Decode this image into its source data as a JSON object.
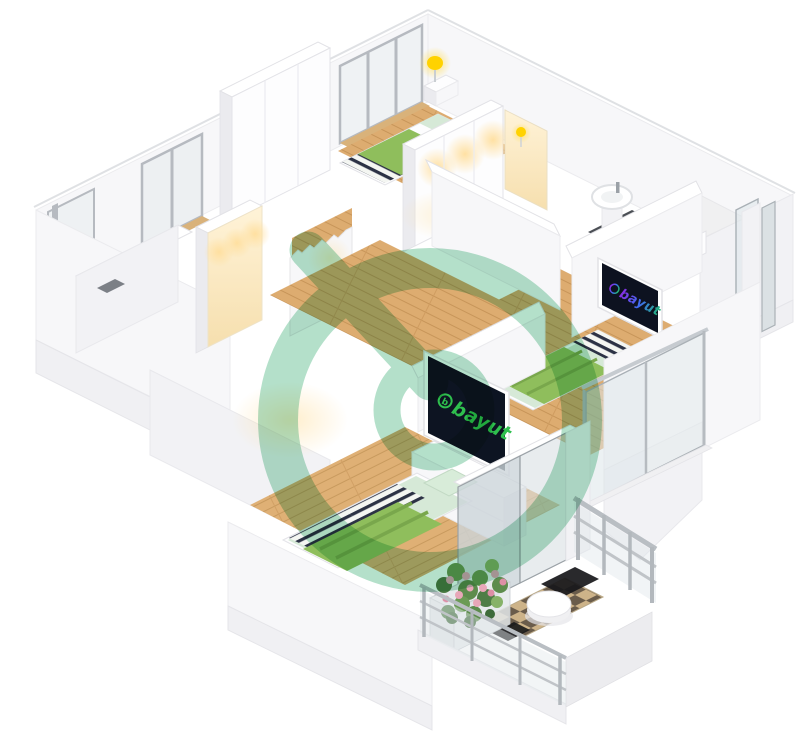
{
  "page": {
    "background": "#ffffff",
    "subject": "3D isometric apartment floor plan rendering",
    "brand": "bayut"
  },
  "watermark": {
    "brand": "bayut",
    "shape": "ring-and-b-logo",
    "color": "#7ecaa3",
    "opacity": 0.58
  },
  "tv_screens": {
    "bedroom_tv": {
      "label": "bayut",
      "icon_letter": "b",
      "logo_color": "#2fbf4e",
      "screen_color": "#0d1422"
    },
    "bathroom_tv": {
      "label": "bayut",
      "icon_letter": "b",
      "logo_gradient": [
        "#8a2be2",
        "#3e6df0",
        "#21b573"
      ],
      "screen_color": "#0d1220"
    }
  },
  "palette": {
    "wall_white": "#f7f7f9",
    "wall_shade": "#ebebef",
    "wood_floor": "#ddac70",
    "wood_plank_line": "#c79559",
    "bed_green": "#8fbe5c",
    "bed_green_dark": "#79a74c",
    "bed_mint": "#d6e9d7",
    "stripe_navy": "#2c3245",
    "lamp_yellow": "#ffd200",
    "warm_glow": "#ffdf9e",
    "tile_tan": "#cdb389",
    "tile_dark": "#6a5c4b",
    "metal_gray": "#b4b9be",
    "glass_blue": "#dde5e9",
    "watermark_green": "#7ecaa3"
  },
  "scene": {
    "rooms": [
      "bedroom-top",
      "bedroom-middle",
      "bedroom-bottom",
      "bathroom",
      "hallway",
      "stairs",
      "balcony",
      "storage-left"
    ],
    "furniture": [
      "double-bed",
      "wardrobe",
      "nightstand",
      "table-lamp",
      "tv",
      "tv-cabinet",
      "washbasin",
      "toilet",
      "shower-screen",
      "balcony-table",
      "flower-planter",
      "glass-railing"
    ]
  }
}
